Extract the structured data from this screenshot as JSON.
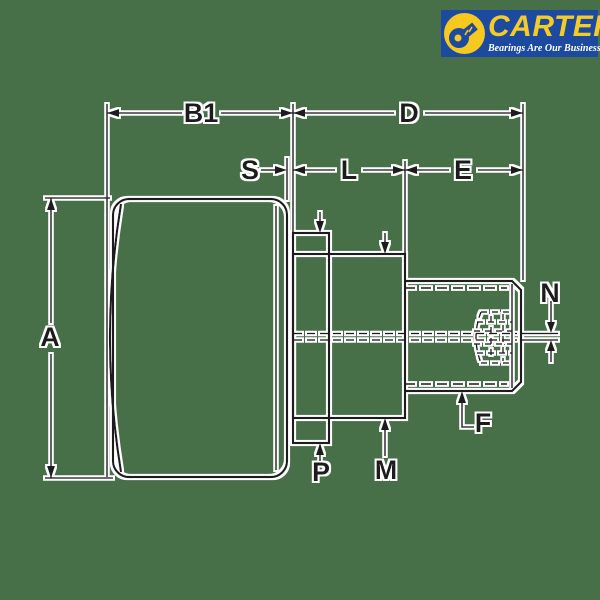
{
  "colors": {
    "background": "#477049",
    "line": "#1B1B1B",
    "halo": "#FFFFFF",
    "logo-bg": "#1C4AA0",
    "logo-yellow": "#F7C81E",
    "logo-text": "#F5CB26",
    "logo-tagline": "#FFFFFF"
  },
  "logo": {
    "brand": "CARTER",
    "tagline": "Bearings Are Our Business"
  },
  "drawing": {
    "description": "Side-view dimensional line drawing of a stud-type cam follower bearing: crowned roller, flange, shoulder, threaded stud with hex socket and grease hole",
    "dimensions": {
      "a": "A",
      "b1": "B1",
      "d": "D",
      "s": "S",
      "l": "L",
      "e": "E",
      "n": "N",
      "p": "P",
      "m": "M",
      "f": "F"
    }
  }
}
